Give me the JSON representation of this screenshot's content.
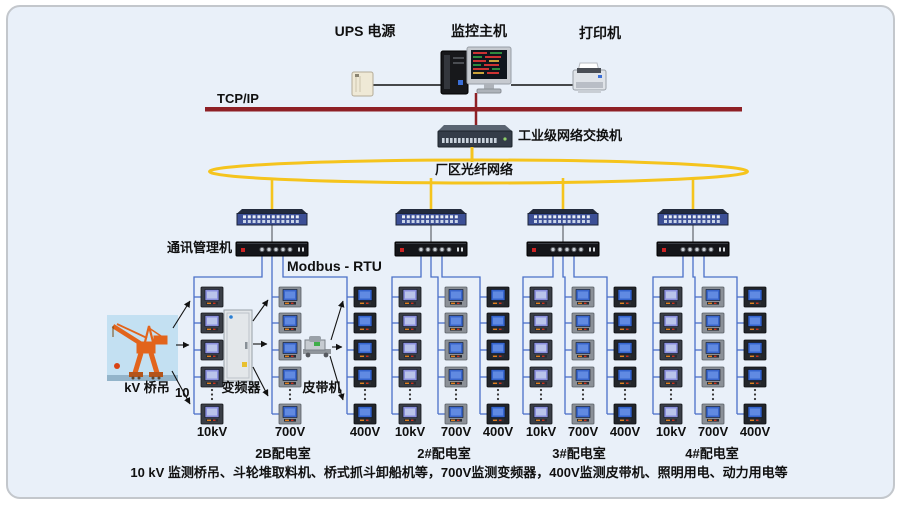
{
  "header": {
    "ups_label": "UPS 电源",
    "host_label": "监控主机",
    "printer_label": "打印机"
  },
  "network": {
    "tcpip_label": "TCP/IP",
    "industrial_switch_label": "工业级网络交换机",
    "fiber_ring_label": "厂区光纤网络",
    "comm_manager_label": "通讯管理机",
    "protocol_label": "Modbus - RTU"
  },
  "field": {
    "crane_prefix": "10",
    "crane_label": "kV 桥吊",
    "converter_label": "变频器",
    "belt_label": "皮带机"
  },
  "groups": [
    {
      "name": "2B配电室",
      "columns": [
        "10kV",
        "700V",
        "400V"
      ]
    },
    {
      "name": "2#配电室",
      "columns": [
        "10kV",
        "700V",
        "400V"
      ]
    },
    {
      "name": "3#配电室",
      "columns": [
        "10kV",
        "700V",
        "400V"
      ]
    },
    {
      "name": "4#配电室",
      "columns": [
        "10kV",
        "700V",
        "400V"
      ]
    }
  ],
  "caption": "10 kV 监测桥吊、斗轮堆取料机、桥式抓斗卸船机等，700V监测变频器，400V监测皮带机、照明用电、动力用电等",
  "colors": {
    "backbone_line": "#8e2025",
    "fiber_ring": "#f5c41d",
    "serial_link": "#4a6fc8",
    "card_bg": "#e9f0f9"
  }
}
